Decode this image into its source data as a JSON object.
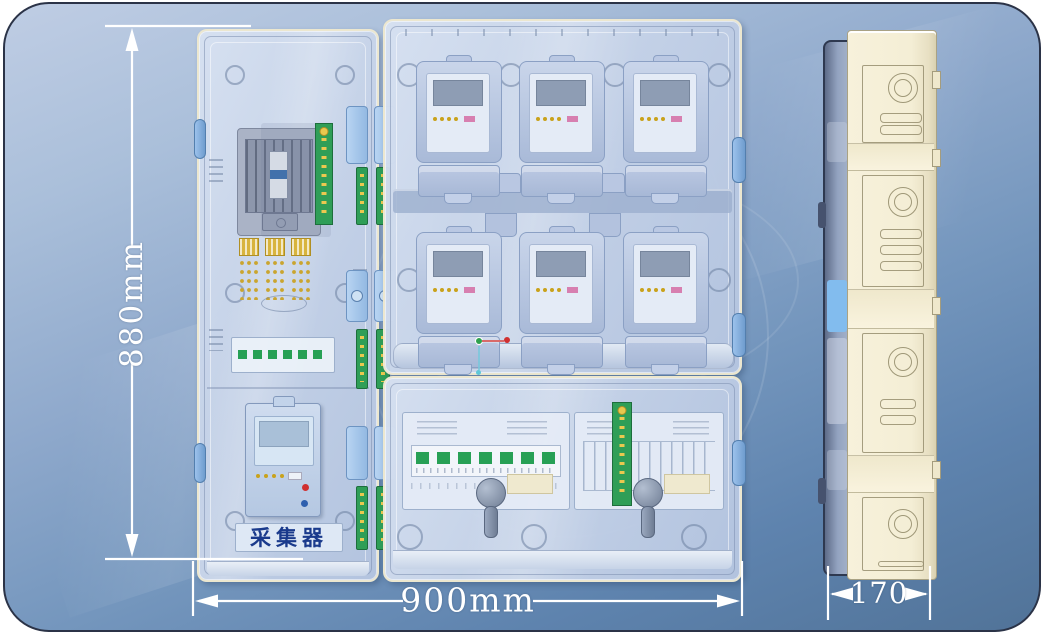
{
  "dimensions": {
    "height_label": "880mm",
    "width_label": "900mm",
    "depth_label": "170"
  },
  "front_view": {
    "left_door": {
      "collector_plaque_label": "采集器",
      "components": [
        "main-breaker",
        "terminal-pcb",
        "fuse-terminal-blocks",
        "wiring-terminal-strip",
        "data-collector-unit"
      ]
    },
    "meter_section": {
      "rows": 2,
      "columns": 3,
      "meter_count": 6
    },
    "lower_section": {
      "breaker_switch_count": 7,
      "components": [
        "breaker-switch-row",
        "terminal-comb",
        "vertical-terminal-pcb",
        "lock-knobs"
      ]
    }
  },
  "side_view": {
    "sections": 4
  },
  "colors": {
    "background_top": "#bfcde4",
    "background_bottom": "#517398",
    "panel_fill": "#cdd9ec",
    "panel_border": "#ece7cf",
    "pcb_green": "#2f9e57",
    "led_gold": "#c9a21b",
    "meter_label_pink": "#d77fb0",
    "hinge_blue": "#84b4e6",
    "side_body_cream": "#f4eed5",
    "dimension_color": "#ffffff",
    "collector_text_color": "#1a3a8c"
  }
}
